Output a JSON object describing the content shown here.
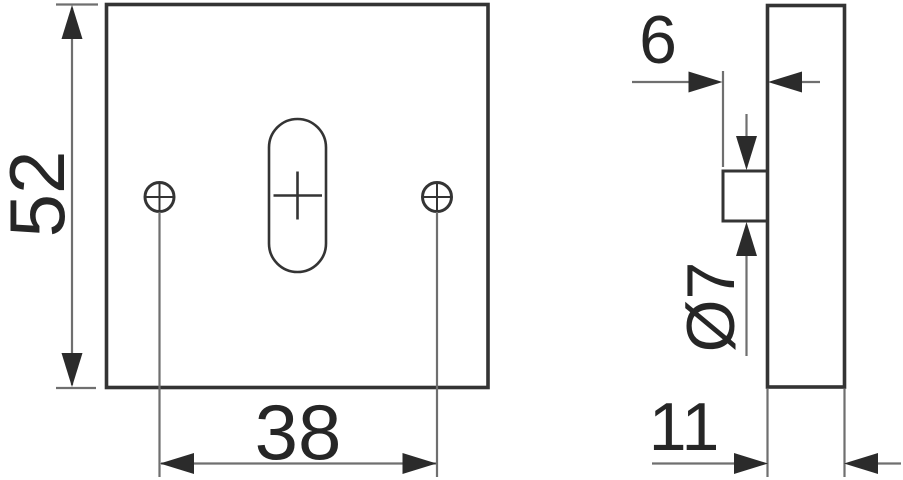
{
  "drawing": {
    "kind": "technical-drawing",
    "dimensions": {
      "plate_height": "52",
      "hole_spacing": "38",
      "pin_protrusion": "6",
      "pin_diameter": "Ø7",
      "plate_thickness": "11"
    }
  },
  "colors": {
    "background": "#ffffff",
    "outline": "#343434",
    "dim_line": "#6f6f6f",
    "arrow": "#2b2b2b",
    "text": "#262626"
  }
}
